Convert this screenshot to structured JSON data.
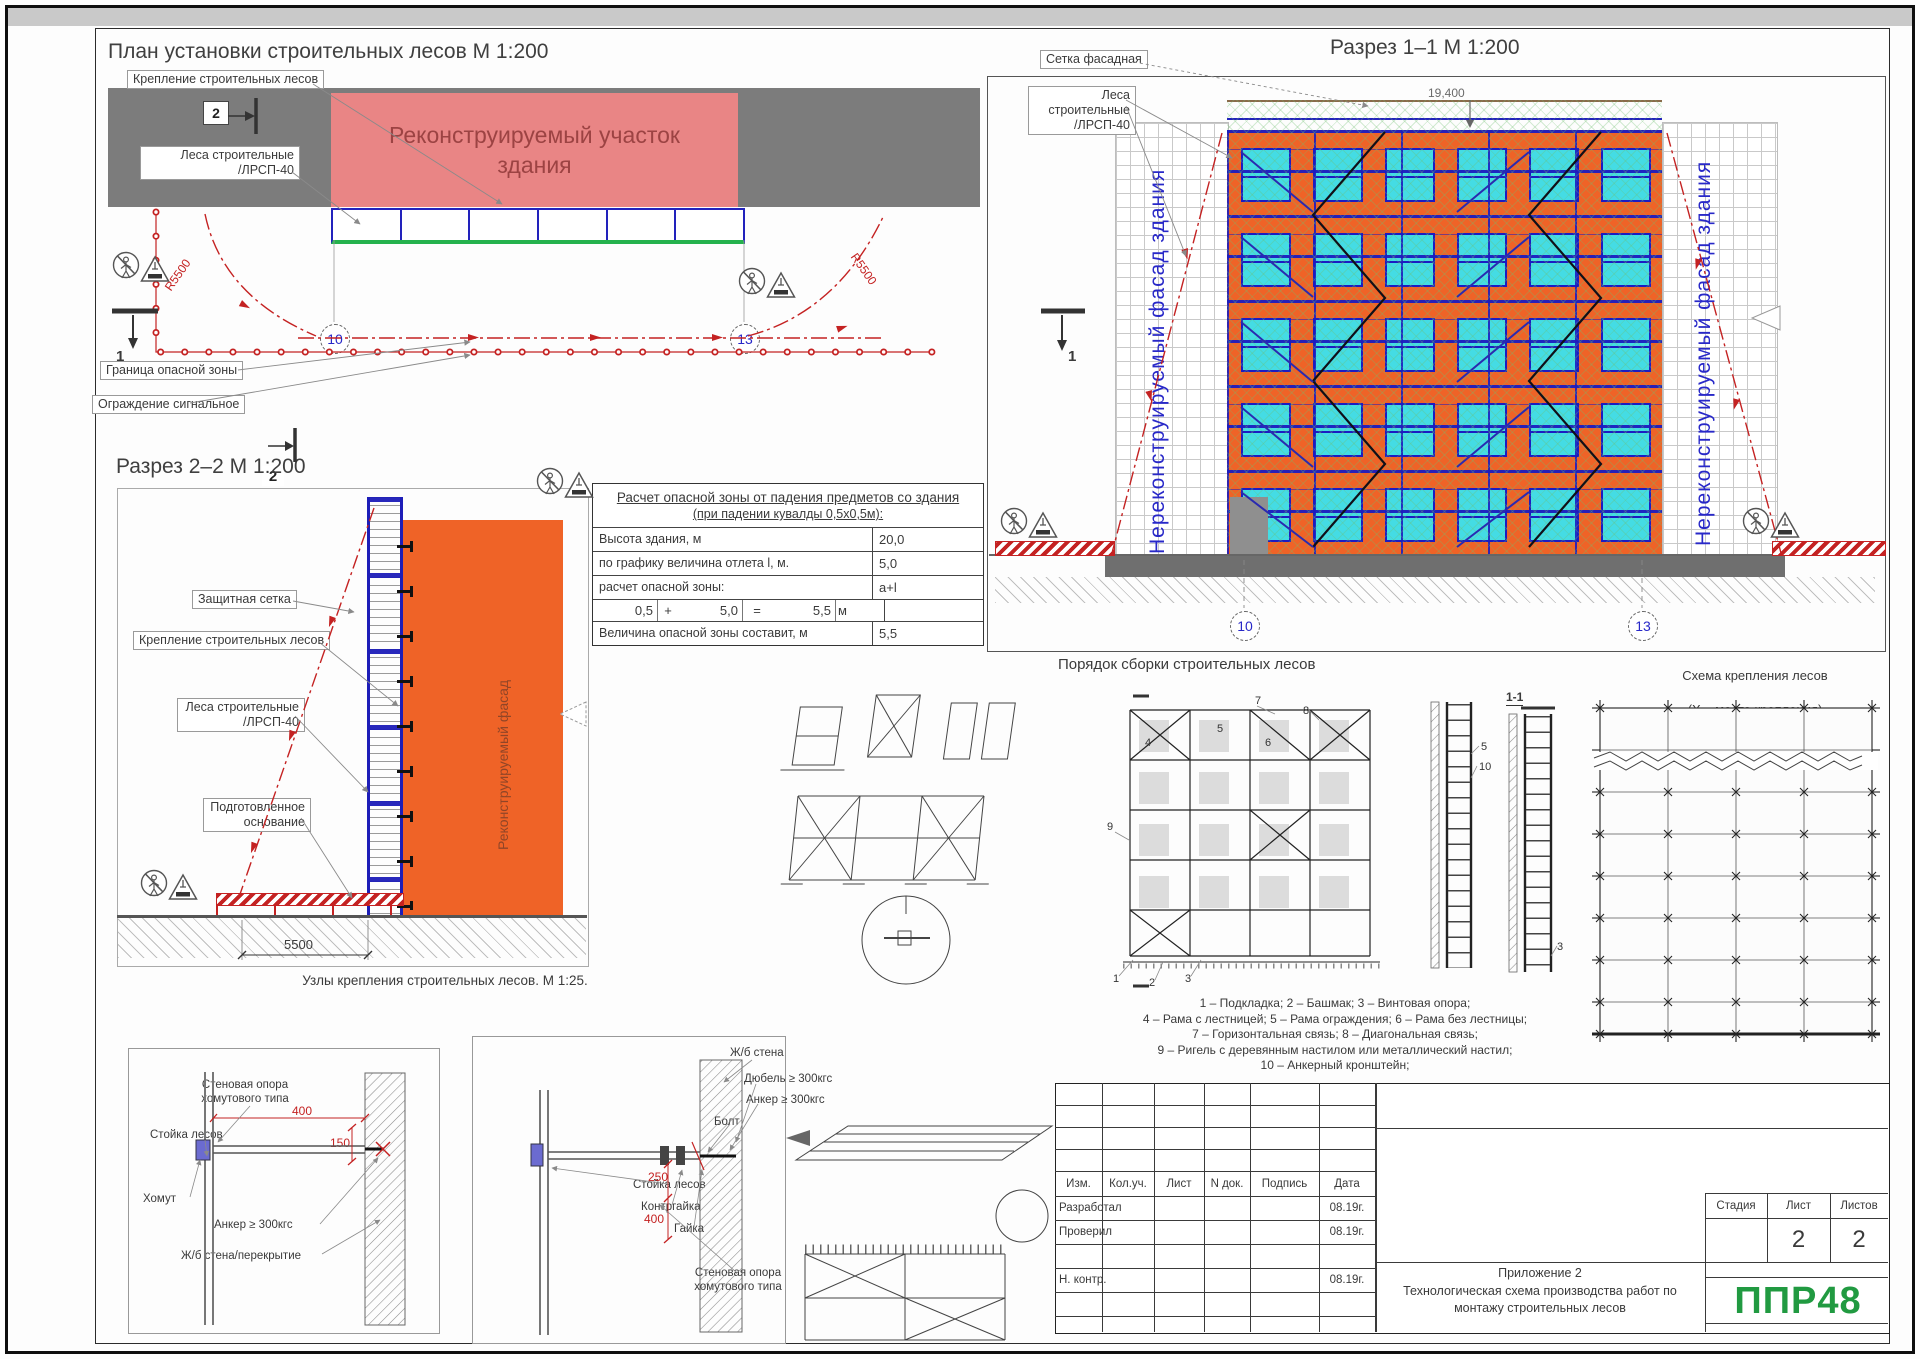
{
  "plan": {
    "title": "План установки строительных лесов М 1:200",
    "label_attach": "Крепление строительных лесов",
    "label_scaffold": "Леса строительные\n/ЛРСП-40",
    "overlay": "Реконструируемый участок\nздания",
    "label_border": "Граница опасной зоны",
    "label_fence": "Ограждение сигнальное",
    "radius_left": "R5500",
    "radius_right": "R5500",
    "axis_left": "10",
    "axis_right": "13",
    "marker_1": "1",
    "marker_2": "2"
  },
  "section11": {
    "title": "Разрез 1–1 М 1:200",
    "label_mesh": "Сетка фасадная",
    "label_scaffold": "Леса строительные\n/ЛРСП-40",
    "left_facade": "Нереконструируемый фасад здания",
    "right_facade": "Нереконструируемый фасад здания",
    "elevation": "19,400",
    "axis_left": "10",
    "axis_right": "13",
    "marker_1": "1"
  },
  "danger_table": {
    "title": "Расчет опасной зоны от падения предметов со здания",
    "subtitle": "(при падении кувалды 0,5х0,5м):",
    "rows": [
      {
        "label": "Высота здания, м",
        "value": "20,0"
      },
      {
        "label": "по графику величина отлета l, м.",
        "value": "5,0"
      },
      {
        "label": "расчет опасной зоны:",
        "value": "a+l"
      }
    ],
    "calc": {
      "a": "0,5",
      "plus": "+",
      "b": "5,0",
      "eq": "=",
      "sum": "5,5",
      "unit": "м"
    },
    "total_label": "Величина опасной зоны составит, м",
    "total_value": "5,5"
  },
  "section22": {
    "title": "Разрез 2–2 М 1:200",
    "label_net": "Защитная сетка",
    "label_attach": "Крепление строительных лесов",
    "label_scaffold": "Леса строительные\n/ЛРСП-40",
    "label_base": "Подготовленное\nоснование",
    "facade_text": "Реконструируемый\nфасад",
    "dim": "5500"
  },
  "nodes": {
    "caption": "Узлы крепления строительных лесов. М 1:25.",
    "left": {
      "label_support": "Стеновая опора\nхомутового типа",
      "label_stand": "Стойка лесов",
      "label_clamp": "Хомут",
      "label_anchor": "Анкер  ≥ 300кгс",
      "label_wall": "Ж/б стена/перекрытие",
      "dim1": "400",
      "dim2": "150"
    },
    "right": {
      "label_wall": "Ж/б стена",
      "label_dowel": "Дюбель ≥ 300кгс",
      "label_anchor": "Анкер  ≥ 300кгс",
      "label_bolt": "Болт",
      "label_stand": "Стойка лесов",
      "label_locknut": "Контргайка",
      "label_nut": "Гайка",
      "label_support": "Стеновая опора\nхомутового типа",
      "dim1": "250",
      "dim2": "400"
    }
  },
  "assembly": {
    "caption": "Порядок сборки строительных лесов",
    "detail": "1-1",
    "legend": "1 – Подкладка; 2 – Башмак; 3 – Винтовая опора;\n4 – Рама с лестницей; 5 – Рама ограждения; 6 – Рама без лестницы;\n7 – Горизонтальная связь; 8 – Диагональная связь;\n9 – Ригель с деревянным настилом или металлический настил;\n10 – Анкерный кронштейн;",
    "callouts": {
      "c1": "1",
      "c2": "2",
      "c3": "3",
      "c4": "4",
      "c5": "5",
      "c6": "6",
      "c7": "7",
      "c8": "8",
      "c9": "9",
      "c10": "10"
    }
  },
  "scheme": {
    "caption_line1": "Схема крепления лесов",
    "caption_line2": "(Х – место крепления)"
  },
  "titleblock": {
    "cols": [
      "Изм.",
      "Кол.уч.",
      "Лист",
      "N док.",
      "Подпись",
      "Дата"
    ],
    "rows": [
      {
        "role": "Разработал",
        "date": "08.19г."
      },
      {
        "role": "Проверил",
        "date": "08.19г."
      },
      {
        "role": "",
        "date": ""
      },
      {
        "role": "Н. контр.",
        "date": "08.19г."
      }
    ],
    "appendix": "Приложение 2",
    "doc_title": "Технологическая схема производства работ по\nмонтажу строительных лесов",
    "stage_label": "Стадия",
    "sheet_label": "Лист",
    "sheets_label": "Листов",
    "sheet": "2",
    "sheets": "2",
    "logo": "ППР48"
  },
  "colors": {
    "facade_orange": "#ef6327",
    "overlay_red": "#e98585",
    "scaffold_blue": "#2222bc",
    "danger_red": "#c42222",
    "logo_green": "#219a41"
  }
}
